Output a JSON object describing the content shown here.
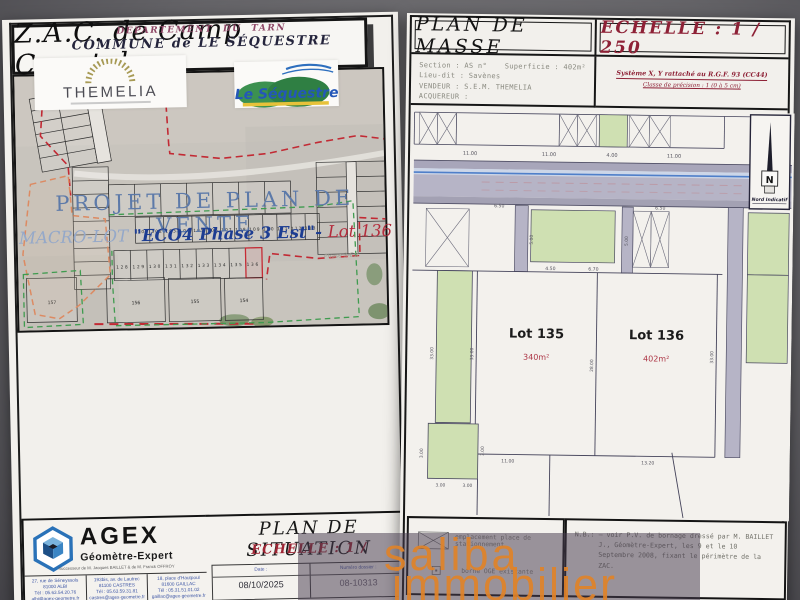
{
  "watermark": {
    "line1": "saliba",
    "line2": "immobilier"
  },
  "left_doc": {
    "header": {
      "department": "DEPARTEMENT DU TARN",
      "commune": "COMMUNE de LE SÉQUESTRE"
    },
    "logos": {
      "themelia_name": "THEMELIA",
      "sequestre_name": "Le Séquestre"
    },
    "title": "Z.A.C. de Camp Countal",
    "subtitle": "PROJET DE PLAN DE VENTE",
    "macro_lot": {
      "prefix": "MACRO-LOT ",
      "name": "\"ECO4 Phase 3 Est\"",
      "sep": "- ",
      "lot": "Lot 136"
    },
    "map": {
      "row1_lots": [
        "101",
        "102",
        "103",
        "104",
        "105",
        "106",
        "107",
        "108",
        "109",
        "110",
        "111",
        "112",
        "113"
      ],
      "row2_lots": [
        "128",
        "129",
        "130",
        "131",
        "132",
        "133",
        "134",
        "135",
        "136"
      ],
      "big_lots": [
        "157",
        "156",
        "155",
        "154"
      ],
      "phase_label": "Phase 3-Est"
    },
    "footer": {
      "agex_name": "AGEX",
      "agex_subtitle": "Géomètre-Expert",
      "agex_successor": "Successeur de M. Jacques BAILLET & de M. Franck OFFROY",
      "offices": [
        {
          "addr": "27, rue de Séneyssols",
          "city": "81000 ALBI",
          "tel": "Tél : 05.63.54.20.76",
          "email": "albi@agex-geometre.fr"
        },
        {
          "addr": "193bis, av. de Lautrec",
          "city": "81100 CASTRES",
          "tel": "Tél : 05.63.59.31.81",
          "email": "castres@agex-geometre.fr"
        },
        {
          "addr": "18, place d'Hautpoul",
          "city": "81600 GAILLAC",
          "tel": "Tél : 05.31.51.01.02",
          "email": "gaillac@agex-geometre.fr"
        }
      ],
      "plan_title": "PLAN DE SITUATION",
      "echelle": "ECHELLE : 1 /",
      "table": {
        "date_label": "Date :",
        "date_value": "08/10/2025",
        "file_label": "Numéro dossier :",
        "file_value": "08-10313"
      }
    }
  },
  "right_doc": {
    "title": "PLAN DE MASSE",
    "echelle": "ECHELLE : 1 / 250",
    "georef_line1": "Système X, Y rattaché au R.G.F. 93 (CC44)",
    "georef_line2": "Classe de précision : 1 (0 à 5 cm)",
    "info": {
      "section": "Section : AS n°",
      "superficie": "Superficie : 402m²",
      "lieu_dit": "Lieu-dit : Savènes",
      "vendeur": "VENDEUR : S.E.M. THEMELIA",
      "acquereur": "ACQUEREUR :"
    },
    "north": {
      "letter": "N",
      "caption": "Nord Indicatif"
    },
    "plan": {
      "lot135_name": "Lot 135",
      "lot135_area": "340m²",
      "lot136_name": "Lot 136",
      "lot136_area": "402m²",
      "dims": {
        "top1": "11.00",
        "top2": "11.00",
        "top3": "4.00",
        "top4": "11.00",
        "mid1": "6.50",
        "mid2": "6.50",
        "v1": "5.00",
        "v2": "5.00",
        "b1": "4.50",
        "b2": "6.70",
        "left1": "33.00",
        "left2": "33.00",
        "center": "28.00",
        "right1": "33.00",
        "low1": "11.00",
        "low2": "13.20",
        "g1": "3.00",
        "g2": "3.00",
        "g3": "3.00",
        "g4": "3.00"
      }
    },
    "legend": {
      "parking": "emplacement place de stationnement",
      "borne": "borne OGE existante"
    },
    "nb_label": "N.B.:",
    "nb_text": "— voir P.V. de bornage dressé par M. BAILLET J., Géomètre-Expert, les 9 et le 10 Septembre 2008, fixant le périmètre de la ZAC."
  }
}
